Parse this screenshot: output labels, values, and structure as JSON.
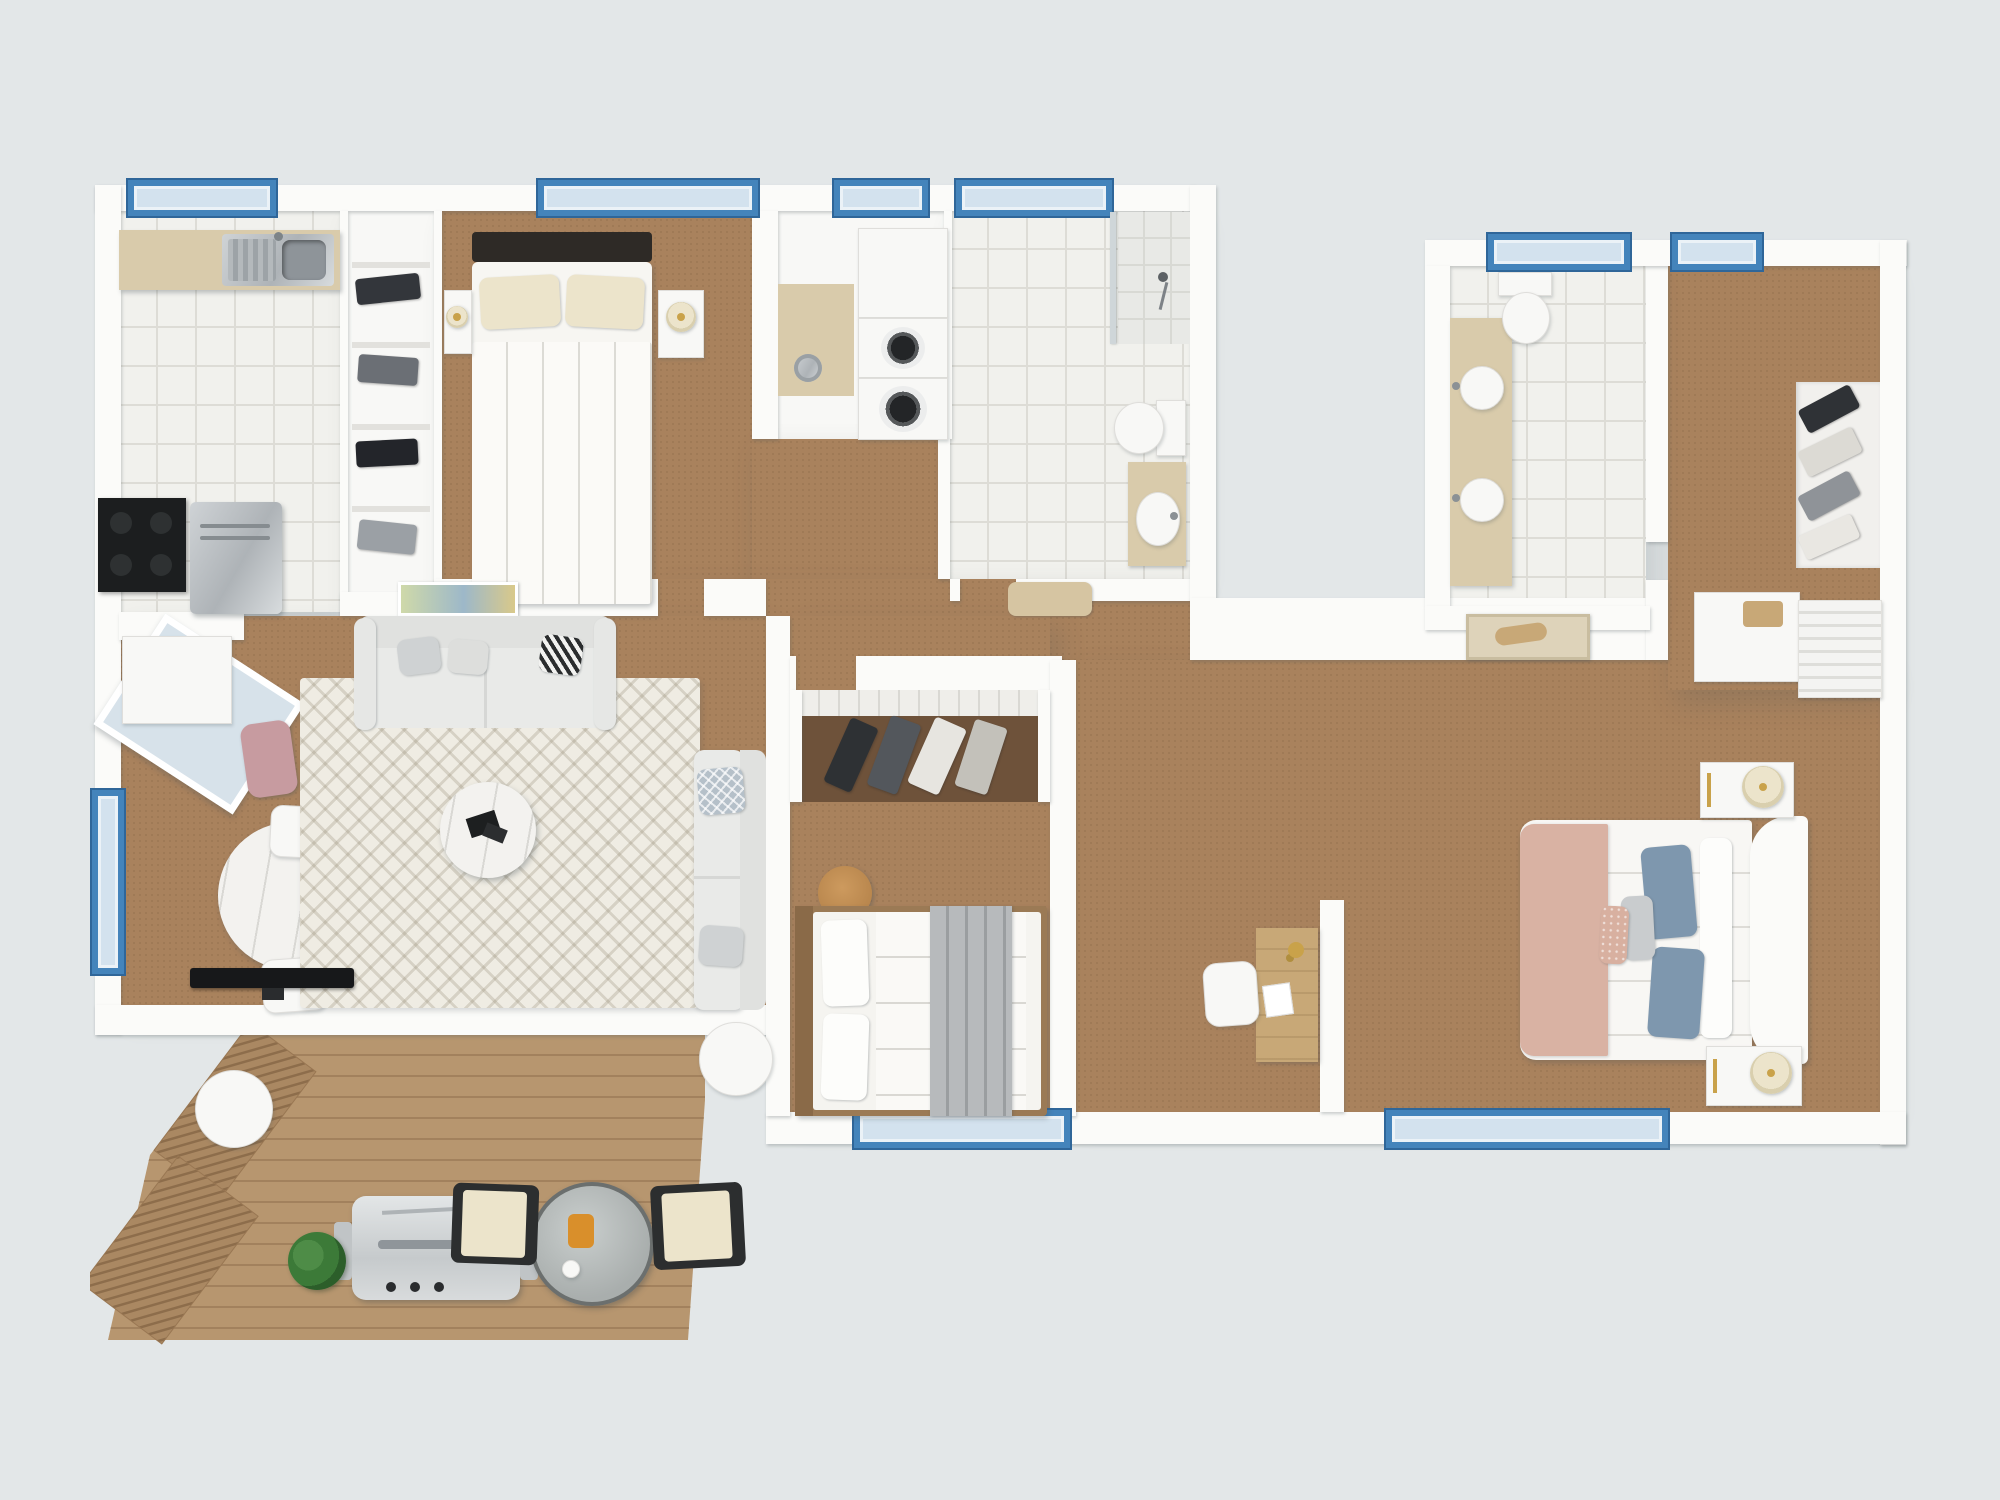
{
  "image_type": "3d-floor-plan-top-down-render",
  "palette": {
    "bg": "#e3e7e8",
    "wall": "#fbfbf9",
    "carpet": "#a9825d",
    "closet-floor": "#6e523a",
    "tile": "#f1f1ed",
    "tile-line": "#dddcd6",
    "wood": "#b7966f",
    "wood-line": "#a2815d",
    "beige": "#d9cbab",
    "frame": "#4484bb",
    "frame-dark": "#2f6699",
    "glass": "#d3e2ee",
    "steel": "#c2c6c9",
    "dark": "#1c1e1f",
    "rug": "#efece3",
    "sofa": "#e9eae8",
    "furn-white": "#f8f8f6",
    "furn-line": "#dfdedb",
    "marble": "#f3f2ef",
    "pillow-gray": "#cfd2d3",
    "pillow-blue": "#7e97ae",
    "blush": "#d9b2a3",
    "gold": "#c9a24a",
    "plant": "#3c7a38",
    "glass-table": "#b7bcbb",
    "cream": "#ece4cb",
    "wood-furn": "#c8a877",
    "blanket-gray": "#b7babc",
    "mat": "#d6c5a2"
  },
  "plan": {
    "sections": [
      {
        "name": "main-living-wing",
        "rooms": [
          {
            "name": "kitchen",
            "floor": "white-tile",
            "windows": 1,
            "furniture": [
              "counter-with-double-sink",
              "stove",
              "refrigerator"
            ]
          },
          {
            "name": "wardrobe-closet",
            "floor": "white",
            "furniture": [
              "shelving-with-folded-clothes"
            ]
          },
          {
            "name": "bedroom-1",
            "floor": "carpet",
            "windows": 1,
            "furniture": [
              "double-bed",
              "two-nightstands",
              "table-lamp",
              "wall-art"
            ]
          },
          {
            "name": "laundry-nook",
            "floor": "white",
            "windows": 1,
            "furniture": [
              "stacked-washer-dryer",
              "cabinet",
              "trash-bin"
            ]
          },
          {
            "name": "bathroom-1",
            "floor": "white-tile",
            "windows": 1,
            "furniture": [
              "walk-in-shower",
              "toilet",
              "vanity-with-sink",
              "bath-mat"
            ]
          },
          {
            "name": "living-dining-room",
            "floor": "carpet",
            "windows": 2,
            "furniture": [
              "three-seat-sofa",
              "chaise-sofa",
              "zigzag-rug",
              "round-coffee-table",
              "round-marble-dining-table",
              "three-dining-chairs",
              "pink-armchair",
              "tv",
              "sideboard",
              "angled-bay-window"
            ]
          },
          {
            "name": "bedroom-2",
            "floor": "carpet",
            "windows": 1,
            "furniture": [
              "double-bed-with-gray-blanket",
              "open-closet-with-hanging-clothes",
              "round-pouf"
            ]
          },
          {
            "name": "hallway",
            "floor": "carpet",
            "furniture": [
              "bath-mat",
              "framed-art-on-wall"
            ]
          }
        ]
      },
      {
        "name": "second-wing",
        "rooms": [
          {
            "name": "bathroom-2",
            "floor": "white-tile",
            "windows": 1,
            "furniture": [
              "double-sink-vanity",
              "toilet"
            ]
          },
          {
            "name": "entry-hall",
            "floor": "carpet",
            "windows": 1,
            "furniture": [
              "dresser-with-tray",
              "open-closet-with-hanging-clothes",
              "slatted-shelf",
              "entry-art"
            ]
          },
          {
            "name": "bedroom-3",
            "floor": "carpet",
            "windows": 1,
            "furniture": [
              "double-bed-with-blush-throw",
              "curved-headboard",
              "two-nightstands-with-lamps",
              "wooden-desk",
              "desk-chair",
              "desk-lamp"
            ]
          }
        ]
      },
      {
        "name": "deck",
        "floor": "wood-planks",
        "furniture": [
          "bbq-grill",
          "potted-plant",
          "round-glass-table",
          "two-outdoor-chairs",
          "two-round-side-tables",
          "slatted-privacy-screens"
        ]
      }
    ]
  }
}
